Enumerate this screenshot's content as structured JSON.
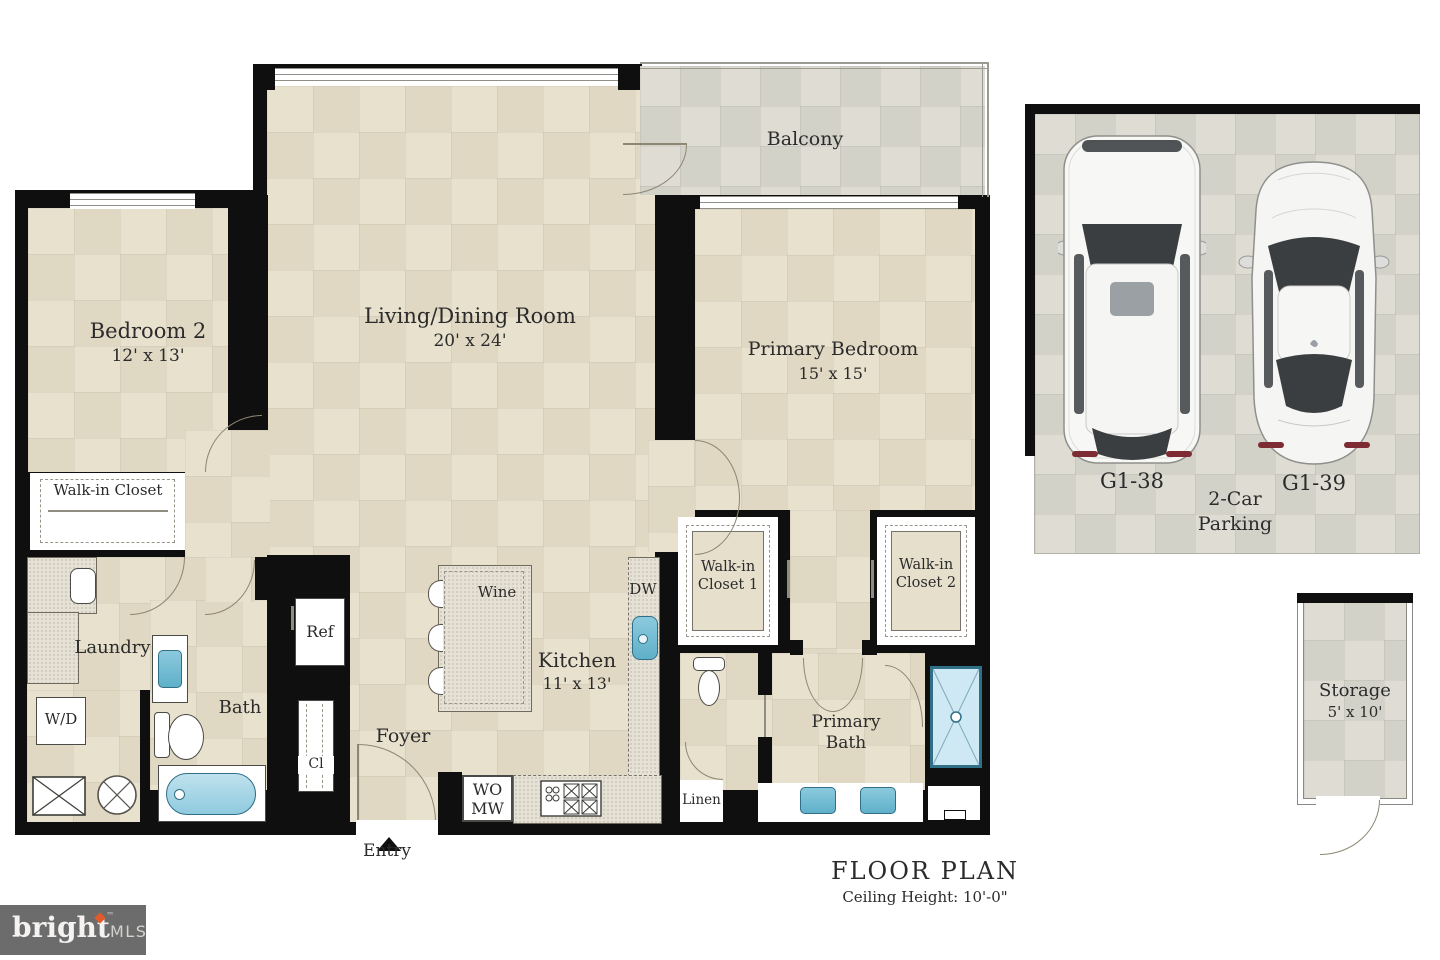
{
  "title": {
    "main": "FLOOR PLAN",
    "sub": "Ceiling Height: 10'-0\""
  },
  "rooms": {
    "bedroom2": {
      "name": "Bedroom 2",
      "dims": "12' x 13'"
    },
    "living": {
      "name": "Living/Dining Room",
      "dims": "20' x 24'"
    },
    "balcony": {
      "name": "Balcony"
    },
    "primary_bedroom": {
      "name": "Primary Bedroom",
      "dims": "15' x 15'"
    },
    "walkin_closet": {
      "name": "Walk-in Closet"
    },
    "laundry": {
      "name": "Laundry"
    },
    "wd": {
      "name": "W/D"
    },
    "bath": {
      "name": "Bath"
    },
    "cl": {
      "name": "Cl"
    },
    "ref": {
      "name": "Ref"
    },
    "foyer": {
      "name": "Foyer"
    },
    "entry": {
      "name": "Entry"
    },
    "kitchen": {
      "name": "Kitchen",
      "dims": "11' x 13'"
    },
    "wine": {
      "name": "Wine"
    },
    "dw": {
      "name": "DW"
    },
    "womw": {
      "line1": "WO",
      "line2": "MW"
    },
    "linen": {
      "name": "Linen"
    },
    "wic1": {
      "name": "Walk-in Closet 1"
    },
    "wic2": {
      "name": "Walk-in Closet 2"
    },
    "primary_bath": {
      "name": "Primary Bath"
    },
    "storage": {
      "name": "Storage",
      "dims": "5' x 10'"
    }
  },
  "parking": {
    "stall1": "G1-38",
    "stall2": "G1-39",
    "caption": "2-Car Parking"
  },
  "logo": {
    "word": "bright",
    "tm": "™",
    "suffix": "MLS"
  },
  "colors": {
    "floor": "#e8e1ce",
    "exterior_floor": "#dedcd3",
    "wall": "#0f0f0f",
    "fixture_blue": "#5fb0c9",
    "shower_blue": "#cfe9f4",
    "logo_bg": "#6c6c6c",
    "logo_accent": "#e05a2b"
  }
}
